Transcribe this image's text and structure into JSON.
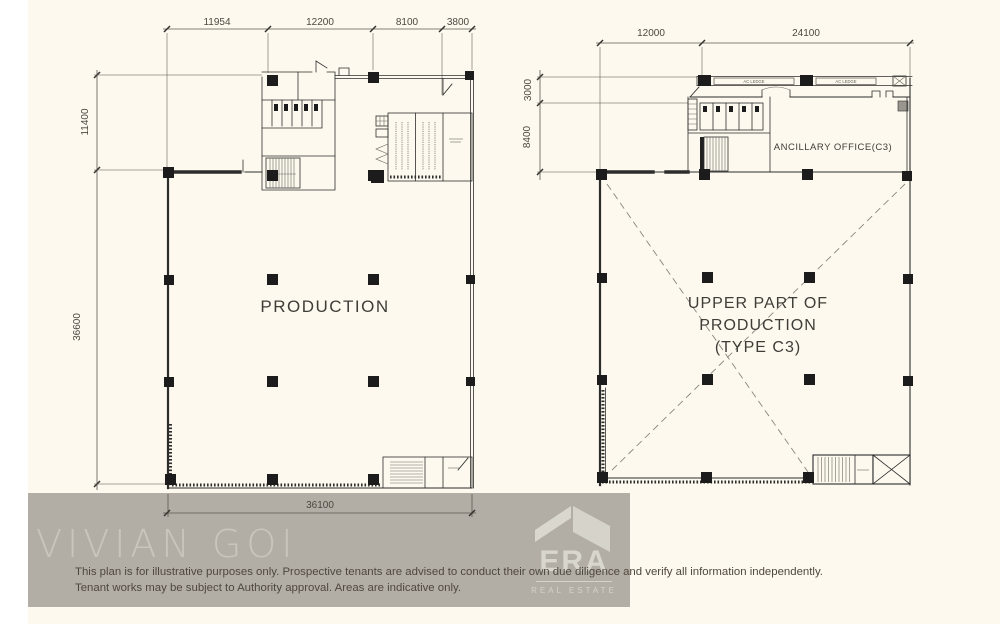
{
  "left_plan": {
    "room_label": "PRODUCTION",
    "dims_top": [
      "11954",
      "12200",
      "8100",
      "3800"
    ],
    "dim_left_upper": "11400",
    "dim_left_lower": "36600",
    "dim_bottom": "36100"
  },
  "right_plan": {
    "room_label_lines": [
      "UPPER PART OF",
      "PRODUCTION",
      "(TYPE C3)"
    ],
    "office_label": "ANCILLARY OFFICE(C3)",
    "ac_ledge_labels": [
      "AC LEDGE",
      "AC LEDGE"
    ],
    "dims_top": [
      "12000",
      "24100"
    ],
    "dim_left_upper": "3000",
    "dim_left_lower": "8400"
  },
  "watermark": {
    "text": "VIVIAN GOI"
  },
  "logo": {
    "brand": "ERA",
    "tagline": "REAL ESTATE"
  },
  "disclaimer": {
    "line1": "This plan is for illustrative purposes only. Prospective tenants are advised to conduct their own due diligence and verify all information independently.",
    "line2": "Tenant works may be subject to Authority approval. Areas are indicative only."
  },
  "colors": {
    "paper": "#fdf9ee",
    "left_margin": "#ffffff",
    "band": "#b3aea5",
    "watermark_text": "#c9c5bc",
    "logo_text": "#d9d6cd",
    "disclaimer_text": "#4e473d",
    "plan_line": "#2d2d2d"
  }
}
